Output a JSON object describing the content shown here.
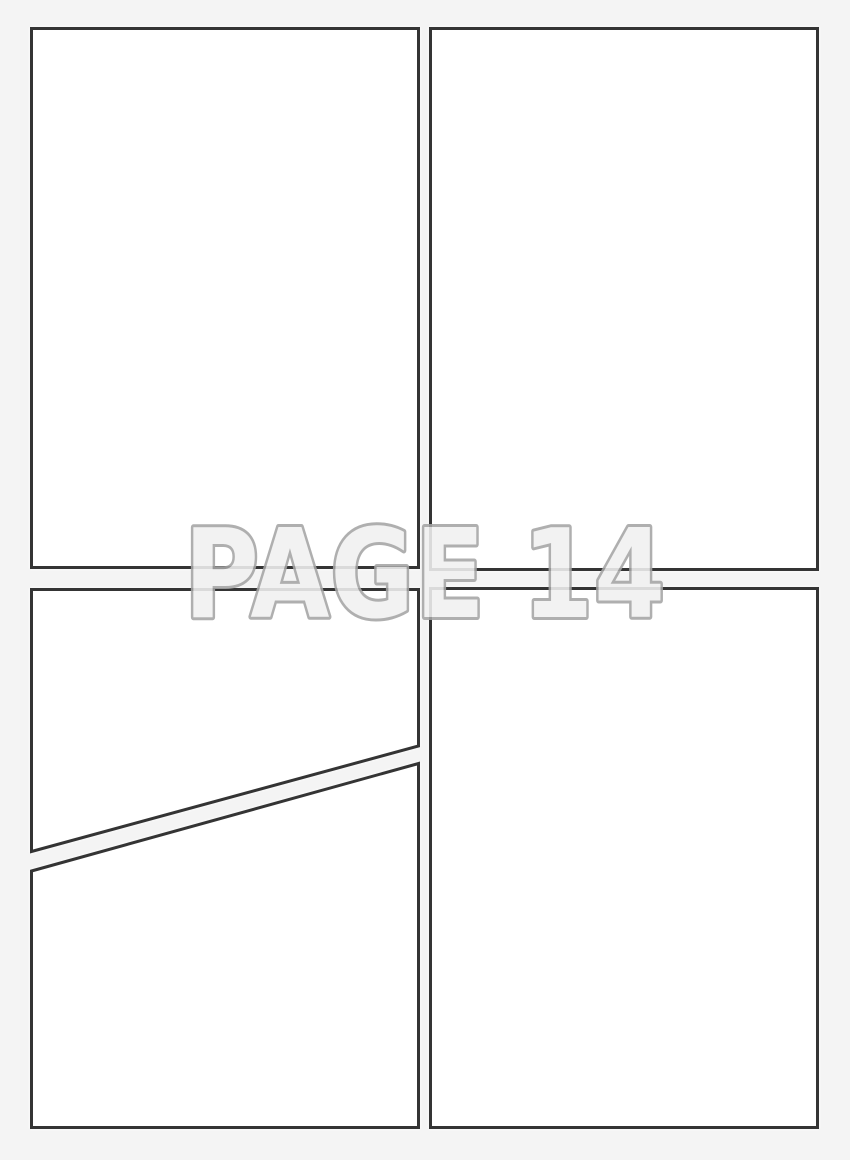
{
  "page": {
    "watermark": "PAGE 14"
  },
  "panels": [
    {
      "id": "top-left"
    },
    {
      "id": "top-right"
    },
    {
      "id": "bottom-left-upper"
    },
    {
      "id": "bottom-left-lower"
    },
    {
      "id": "bottom-right"
    }
  ],
  "colors": {
    "background": "#f4f4f4",
    "panel_fill": "#ffffff",
    "panel_border": "#343434",
    "watermark_fill": "#f1f1f1",
    "watermark_stroke": "#a5a5a5"
  }
}
